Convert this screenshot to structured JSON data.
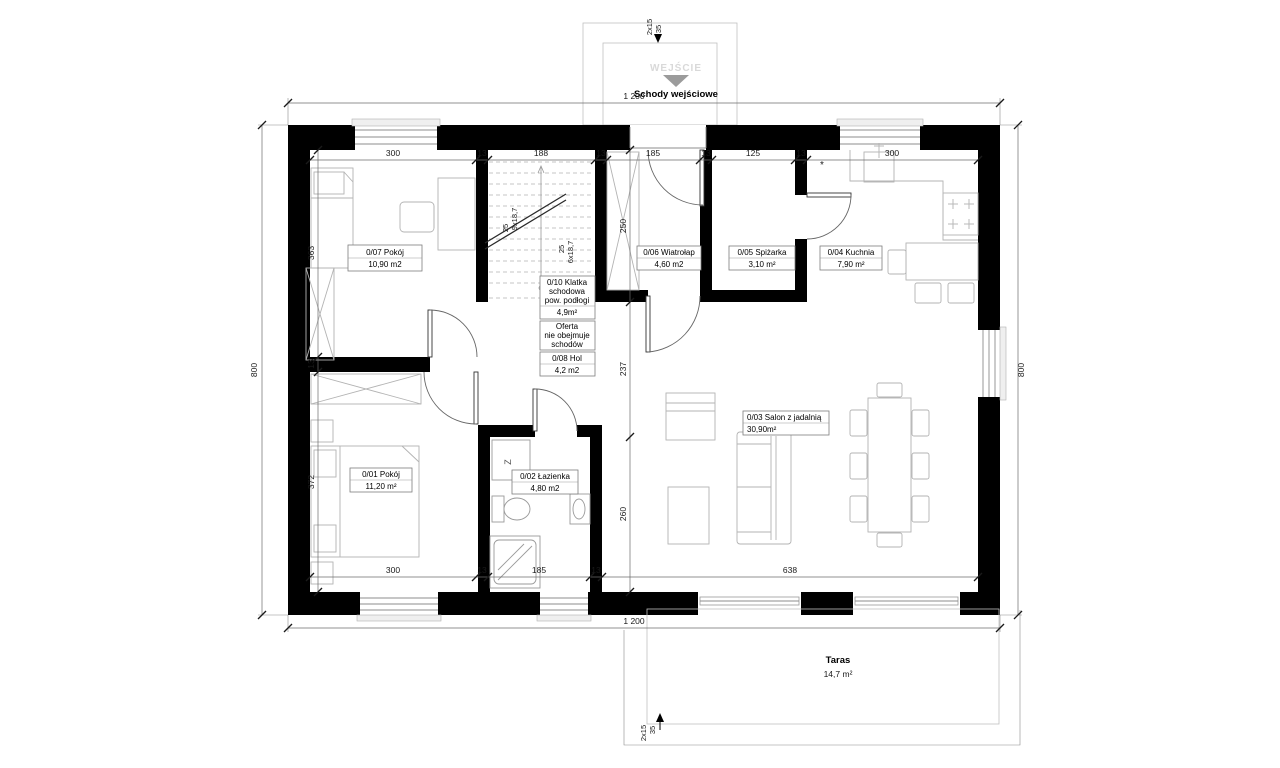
{
  "entrance": {
    "steps": "2x15",
    "rise": "35",
    "label": "WEJŚCIE",
    "title": "Schody wejściowe"
  },
  "terrace": {
    "name": "Taras",
    "area": "14,7 m²",
    "steps": "2x15",
    "rise": "35"
  },
  "dims": {
    "overall_w": "1 200",
    "overall_h": "800",
    "top": [
      "300",
      "13",
      "188",
      "13",
      "185",
      "13",
      "125",
      "13",
      "300"
    ],
    "bottom": [
      "300",
      "13",
      "185",
      "13",
      "638"
    ],
    "left": [
      "363",
      "13",
      "372"
    ],
    "center": [
      "250",
      "237",
      "260"
    ],
    "kitchen_note": "*"
  },
  "stairs": {
    "flight_up": "9x18,7",
    "flight_up_width": "25",
    "flight_low": "6x18,7",
    "flight_low_width": "25"
  },
  "rooms": {
    "r07": {
      "name": "0/07 Pokój",
      "area": "10,90 m2"
    },
    "r10": {
      "name_l1": "0/10 Klatka",
      "name_l2": "schodowa",
      "name_l3": "pow. podłogi",
      "area": "4,9m²"
    },
    "note": {
      "l1": "Oferta",
      "l2": "nie obejmuje",
      "l3": "schodów"
    },
    "r08": {
      "name": "0/08 Hol",
      "area": "4,2 m2"
    },
    "r06": {
      "name": "0/06 Wiatrołap",
      "area": "4,60 m2"
    },
    "r05": {
      "name": "0/05 Spiżarka",
      "area": "3,10 m²"
    },
    "r04": {
      "name": "0/04 Kuchnia",
      "area": "7,90 m²"
    },
    "r01": {
      "name": "0/01 Pokój",
      "area": "11,20 m²"
    },
    "r02": {
      "name": "0/02 Łazienka",
      "area": "4,80 m2"
    },
    "r03": {
      "name": "0/03 Salon z jadalnią",
      "area": "30,90m²"
    }
  },
  "fixtures": {
    "washer": "Z"
  }
}
